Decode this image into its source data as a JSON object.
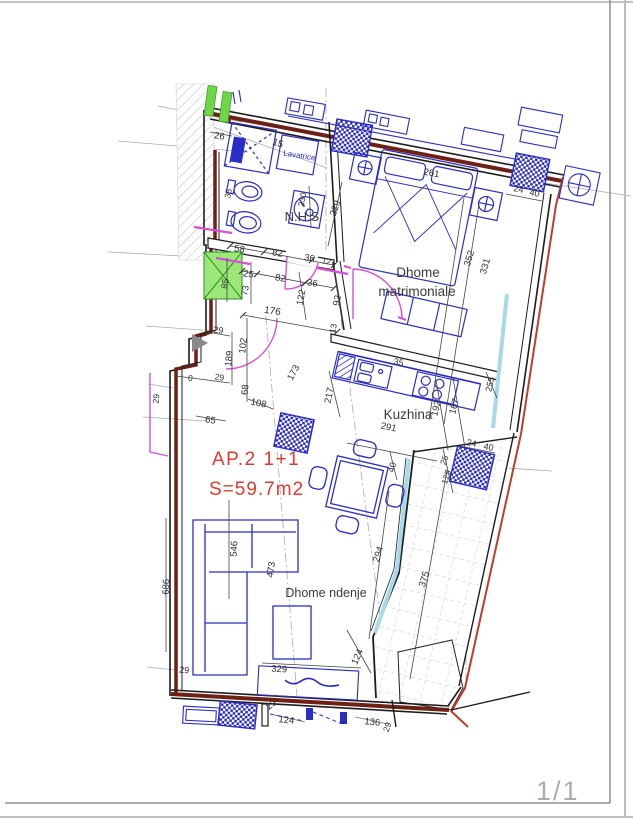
{
  "page": {
    "sheet_number": "1/1"
  },
  "plan": {
    "apartment_label": "AP.2  1+1",
    "area_label": "S=59.7m2",
    "colors": {
      "wall": "#1c1c1c",
      "insulation": "#6e2014",
      "property_line": "#c23b2a",
      "fixture_blue": "#2a2cc7",
      "door_magenta": "#d94fd9",
      "glazing_cyan": "#a7d9ea",
      "shaft_green": "#8ce063",
      "label_red": "#e03a2f",
      "page_grey": "#a8adb3",
      "dim_text": "#2f2f2f"
    },
    "rooms": [
      "N.H.S",
      "Dhome matrimoniale",
      "Kuzhina",
      "Dhome ndenje"
    ],
    "labels": [
      {
        "n": "room-label-nhs",
        "t": "N.H.S",
        "x": 302,
        "y": 221,
        "r": 0,
        "s": 13,
        "c": "#3a3a3a"
      },
      {
        "n": "room-label-bedroom-line1",
        "t": "Dhome",
        "x": 418,
        "y": 277,
        "r": 0,
        "s": 13.5,
        "c": "#3a3a3a"
      },
      {
        "n": "room-label-bedroom-line2",
        "t": "matrimoniale",
        "x": 417,
        "y": 296,
        "r": 0,
        "s": 13.5,
        "c": "#3a3a3a"
      },
      {
        "n": "room-label-kitchen",
        "t": "Kuzhina",
        "x": 408,
        "y": 419,
        "r": 0,
        "s": 13.5,
        "c": "#3a3a3a"
      },
      {
        "n": "room-label-living",
        "t": "Dhome ndenje",
        "x": 326,
        "y": 597,
        "r": 0,
        "s": 12.5,
        "c": "#3a3a3a"
      },
      {
        "n": "fixture-label-lavatrice",
        "t": "Lavatrice",
        "x": 299,
        "y": 158,
        "r": 9,
        "s": 8,
        "c": "#2a2cc7"
      },
      {
        "n": "dim-26",
        "t": "26",
        "x": 219,
        "y": 139,
        "r": 9,
        "s": 9.5,
        "c": "#2f2f2f"
      },
      {
        "n": "dim-15",
        "t": "15",
        "x": 277,
        "y": 146,
        "r": 18,
        "s": 9.5,
        "c": "#2f2f2f"
      },
      {
        "n": "dim-35-bidet",
        "t": "35",
        "x": 231,
        "y": 194,
        "r": -78,
        "s": 8.5,
        "c": "#2f2f2f"
      },
      {
        "n": "dim-230",
        "t": "230",
        "x": 305,
        "y": 200,
        "r": -78,
        "s": 8.5,
        "c": "#2f2f2f"
      },
      {
        "n": "dim-58",
        "t": "58",
        "x": 239,
        "y": 252,
        "r": 9,
        "s": 9.5,
        "c": "#2f2f2f"
      },
      {
        "n": "dim-82a",
        "t": "82",
        "x": 277,
        "y": 256,
        "r": 9,
        "s": 9.5,
        "c": "#2f2f2f"
      },
      {
        "n": "dim-36a",
        "t": "36",
        "x": 309,
        "y": 261,
        "r": 9,
        "s": 9.5,
        "c": "#2f2f2f"
      },
      {
        "n": "dim-12",
        "t": "12",
        "x": 326,
        "y": 264,
        "r": 9,
        "s": 8.5,
        "c": "#2f2f2f"
      },
      {
        "n": "dim-25a",
        "t": "25",
        "x": 248,
        "y": 277,
        "r": 9,
        "s": 9.5,
        "c": "#2f2f2f"
      },
      {
        "n": "dim-82b",
        "t": "82",
        "x": 280,
        "y": 281,
        "r": 9,
        "s": 9.5,
        "c": "#2f2f2f"
      },
      {
        "n": "dim-36b",
        "t": "36",
        "x": 312,
        "y": 286,
        "r": 9,
        "s": 9.5,
        "c": "#2f2f2f"
      },
      {
        "n": "dim-85",
        "t": "85",
        "x": 228,
        "y": 284,
        "r": -80,
        "s": 9,
        "c": "#2f2f2f"
      },
      {
        "n": "dim-73",
        "t": "73",
        "x": 248,
        "y": 291,
        "r": -80,
        "s": 9,
        "c": "#2f2f2f"
      },
      {
        "n": "dim-122",
        "t": "122",
        "x": 304,
        "y": 298,
        "r": -79,
        "s": 9.5,
        "c": "#2f2f2f"
      },
      {
        "n": "dim-92",
        "t": "92",
        "x": 340,
        "y": 301,
        "r": -79,
        "s": 9.5,
        "c": "#2f2f2f"
      },
      {
        "n": "dim-176",
        "t": "176",
        "x": 272,
        "y": 314,
        "r": 9,
        "s": 10,
        "c": "#2f2f2f"
      },
      {
        "n": "dim-229",
        "t": "229",
        "x": 338,
        "y": 209,
        "r": -72,
        "s": 9.5,
        "c": "#2f2f2f"
      },
      {
        "n": "dim-261",
        "t": "261",
        "x": 431,
        "y": 176,
        "r": 10,
        "s": 9.5,
        "c": "#2f2f2f"
      },
      {
        "n": "dim-24a",
        "t": "24",
        "x": 518,
        "y": 192,
        "r": 11,
        "s": 9,
        "c": "#2f2f2f"
      },
      {
        "n": "dim-40a",
        "t": "40",
        "x": 534,
        "y": 196,
        "r": 11,
        "s": 9,
        "c": "#2f2f2f"
      },
      {
        "n": "dim-352",
        "t": "352",
        "x": 472,
        "y": 259,
        "r": -73,
        "s": 9.5,
        "c": "#2f2f2f"
      },
      {
        "n": "dim-331",
        "t": "331",
        "x": 488,
        "y": 267,
        "r": -73,
        "s": 9.5,
        "c": "#2f2f2f"
      },
      {
        "n": "dim-13",
        "t": "13",
        "x": 336,
        "y": 329,
        "r": -79,
        "s": 8.5,
        "c": "#2f2f2f"
      },
      {
        "n": "dim-29a",
        "t": "29",
        "x": 218,
        "y": 333,
        "r": 9,
        "s": 9,
        "c": "#2f2f2f"
      },
      {
        "n": "dim-0",
        "t": "0",
        "x": 190,
        "y": 381,
        "r": 9,
        "s": 8.5,
        "c": "#2f2f2f"
      },
      {
        "n": "dim-29b",
        "t": "29",
        "x": 219,
        "y": 380,
        "r": 9,
        "s": 8.5,
        "c": "#2f2f2f"
      },
      {
        "n": "dim-29c",
        "t": "29",
        "x": 159,
        "y": 399,
        "r": -84,
        "s": 8.5,
        "c": "#2f2f2f"
      },
      {
        "n": "dim-189",
        "t": "189",
        "x": 232,
        "y": 359,
        "r": -84,
        "s": 9.5,
        "c": "#2f2f2f"
      },
      {
        "n": "dim-102",
        "t": "102",
        "x": 246,
        "y": 346,
        "r": -84,
        "s": 9.5,
        "c": "#2f2f2f"
      },
      {
        "n": "dim-68",
        "t": "68",
        "x": 248,
        "y": 390,
        "r": -84,
        "s": 9.5,
        "c": "#2f2f2f"
      },
      {
        "n": "dim-108",
        "t": "108",
        "x": 258,
        "y": 406,
        "r": 12,
        "s": 9.5,
        "c": "#2f2f2f"
      },
      {
        "n": "dim-65",
        "t": "65",
        "x": 210,
        "y": 423,
        "r": 8,
        "s": 9.5,
        "c": "#2f2f2f"
      },
      {
        "n": "dim-173",
        "t": "173",
        "x": 296,
        "y": 374,
        "r": -62,
        "s": 9.5,
        "c": "#2f2f2f"
      },
      {
        "n": "dim-217",
        "t": "217",
        "x": 332,
        "y": 396,
        "r": -78,
        "s": 9.5,
        "c": "#2f2f2f"
      },
      {
        "n": "dim-35-counter",
        "t": "35",
        "x": 398,
        "y": 365,
        "r": 12,
        "s": 9,
        "c": "#2f2f2f"
      },
      {
        "n": "dim-291",
        "t": "291",
        "x": 388,
        "y": 430,
        "r": 12,
        "s": 9.5,
        "c": "#2f2f2f"
      },
      {
        "n": "dim-192",
        "t": "192",
        "x": 439,
        "y": 409,
        "r": -76,
        "s": 9.5,
        "c": "#2f2f2f"
      },
      {
        "n": "dim-167",
        "t": "167",
        "x": 457,
        "y": 407,
        "r": -76,
        "s": 9.5,
        "c": "#2f2f2f"
      },
      {
        "n": "dim-255",
        "t": "255",
        "x": 493,
        "y": 385,
        "r": -76,
        "s": 9,
        "c": "#2f2f2f"
      },
      {
        "n": "dim-40b",
        "t": "40",
        "x": 395,
        "y": 468,
        "r": -76,
        "s": 9,
        "c": "#2f2f2f"
      },
      {
        "n": "dim-25b",
        "t": "25",
        "x": 447,
        "y": 461,
        "r": -72,
        "s": 8.5,
        "c": "#2f2f2f"
      },
      {
        "n": "dim-125",
        "t": "125",
        "x": 449,
        "y": 478,
        "r": -72,
        "s": 8.5,
        "c": "#2f2f2f"
      },
      {
        "n": "dim-24b",
        "t": "24",
        "x": 471,
        "y": 446,
        "r": 11,
        "s": 9,
        "c": "#2f2f2f"
      },
      {
        "n": "dim-40c",
        "t": "40",
        "x": 488,
        "y": 450,
        "r": 11,
        "s": 9,
        "c": "#2f2f2f"
      },
      {
        "n": "dim-375",
        "t": "375",
        "x": 427,
        "y": 580,
        "r": -73,
        "s": 9.5,
        "c": "#2f2f2f"
      },
      {
        "n": "dim-294",
        "t": "294",
        "x": 381,
        "y": 555,
        "r": -73,
        "s": 9.5,
        "c": "#2f2f2f"
      },
      {
        "n": "dim-546",
        "t": "546",
        "x": 237,
        "y": 549,
        "r": -87,
        "s": 9.5,
        "c": "#2f2f2f"
      },
      {
        "n": "dim-473",
        "t": "473",
        "x": 274,
        "y": 570,
        "r": -82,
        "s": 9.5,
        "c": "#2f2f2f"
      },
      {
        "n": "dim-686",
        "t": "686",
        "x": 169,
        "y": 587,
        "r": -87,
        "s": 9.5,
        "c": "#2f2f2f"
      },
      {
        "n": "dim-329",
        "t": "329",
        "x": 279,
        "y": 672,
        "r": 4,
        "s": 9.5,
        "c": "#2f2f2f"
      },
      {
        "n": "dim-29d",
        "t": "29",
        "x": 184,
        "y": 673,
        "r": 4,
        "s": 9,
        "c": "#2f2f2f"
      },
      {
        "n": "dim-124a",
        "t": "124",
        "x": 360,
        "y": 658,
        "r": -66,
        "s": 9.5,
        "c": "#2f2f2f"
      },
      {
        "n": "dim-29e",
        "t": "29",
        "x": 273,
        "y": 707,
        "r": -38,
        "s": 9,
        "c": "#2f2f2f"
      },
      {
        "n": "dim-124b",
        "t": "124",
        "x": 286,
        "y": 723,
        "r": 6,
        "s": 9.5,
        "c": "#2f2f2f"
      },
      {
        "n": "dim-136",
        "t": "136",
        "x": 372,
        "y": 725,
        "r": 6,
        "s": 9.5,
        "c": "#2f2f2f"
      },
      {
        "n": "dim-29f",
        "t": "29",
        "x": 390,
        "y": 728,
        "r": -70,
        "s": 8.5,
        "c": "#2f2f2f"
      }
    ]
  }
}
